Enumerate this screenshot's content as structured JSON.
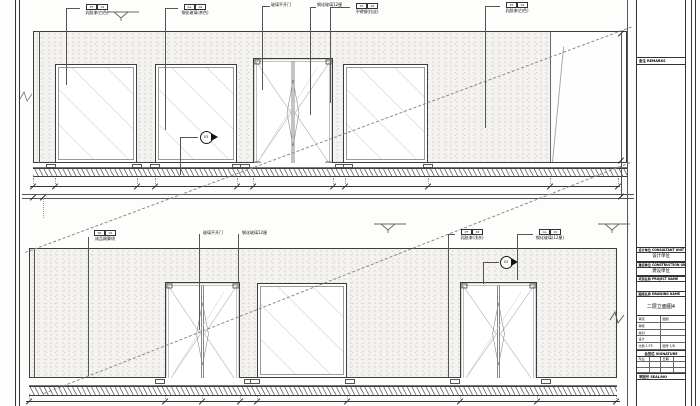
{
  "drawing": {
    "tags_top": [
      {
        "code_a": "PT",
        "code_b": "01",
        "label": "乳胶漆(白色)"
      },
      {
        "code_a": "GL",
        "code_b": "02",
        "label": "钢化玻璃(茶色)"
      },
      {
        "label": "玻璃平开门"
      },
      {
        "label": "钢化玻璃12厘"
      },
      {
        "code_a": "ST",
        "code_b": "01",
        "label": "不锈钢(拉丝)"
      },
      {
        "code_a": "PT",
        "code_b": "01",
        "label": "乳胶漆(白色)"
      }
    ],
    "tags_bottom": [
      {
        "code_a": "SK",
        "code_b": "01",
        "label": "成品踢脚线"
      },
      {
        "label": "玻璃平开门"
      },
      {
        "label": "钢化玻璃12厘"
      },
      {
        "code_a": "PT",
        "code_b": "02",
        "label": "乳胶漆(浅灰)"
      },
      {
        "code_a": "GL",
        "code_b": "01",
        "label": "钢化玻璃(12厘)"
      }
    ],
    "section_markers": [
      {
        "label": "03"
      },
      {
        "label": "03"
      }
    ]
  },
  "title_block": {
    "top_band": "备注 REMARKS",
    "rows": [
      {
        "header": "设计单位 CONSULTANT UNIT",
        "value": "设计单位"
      },
      {
        "header": "建设单位 CONSTRUCTION UNIT",
        "value": "建设单位"
      },
      {
        "header": "项目名称 PROJECT NAME",
        "value": ""
      },
      {
        "header": "图纸名称 DRAWING NAME",
        "value": "二层立面图4"
      }
    ],
    "info_left": [
      "审定",
      "审核",
      "校对",
      "设计",
      "比例 1:75"
    ],
    "info_right": [
      "图别",
      "",
      "",
      "",
      "图号 1/8"
    ],
    "sign_band": "会签栏 SIGNATURE",
    "sign_rows": [
      [
        "专业",
        "日期"
      ],
      [
        "",
        ""
      ],
      [
        "",
        ""
      ]
    ],
    "seal_band": "审图号 SEAL/NO"
  }
}
